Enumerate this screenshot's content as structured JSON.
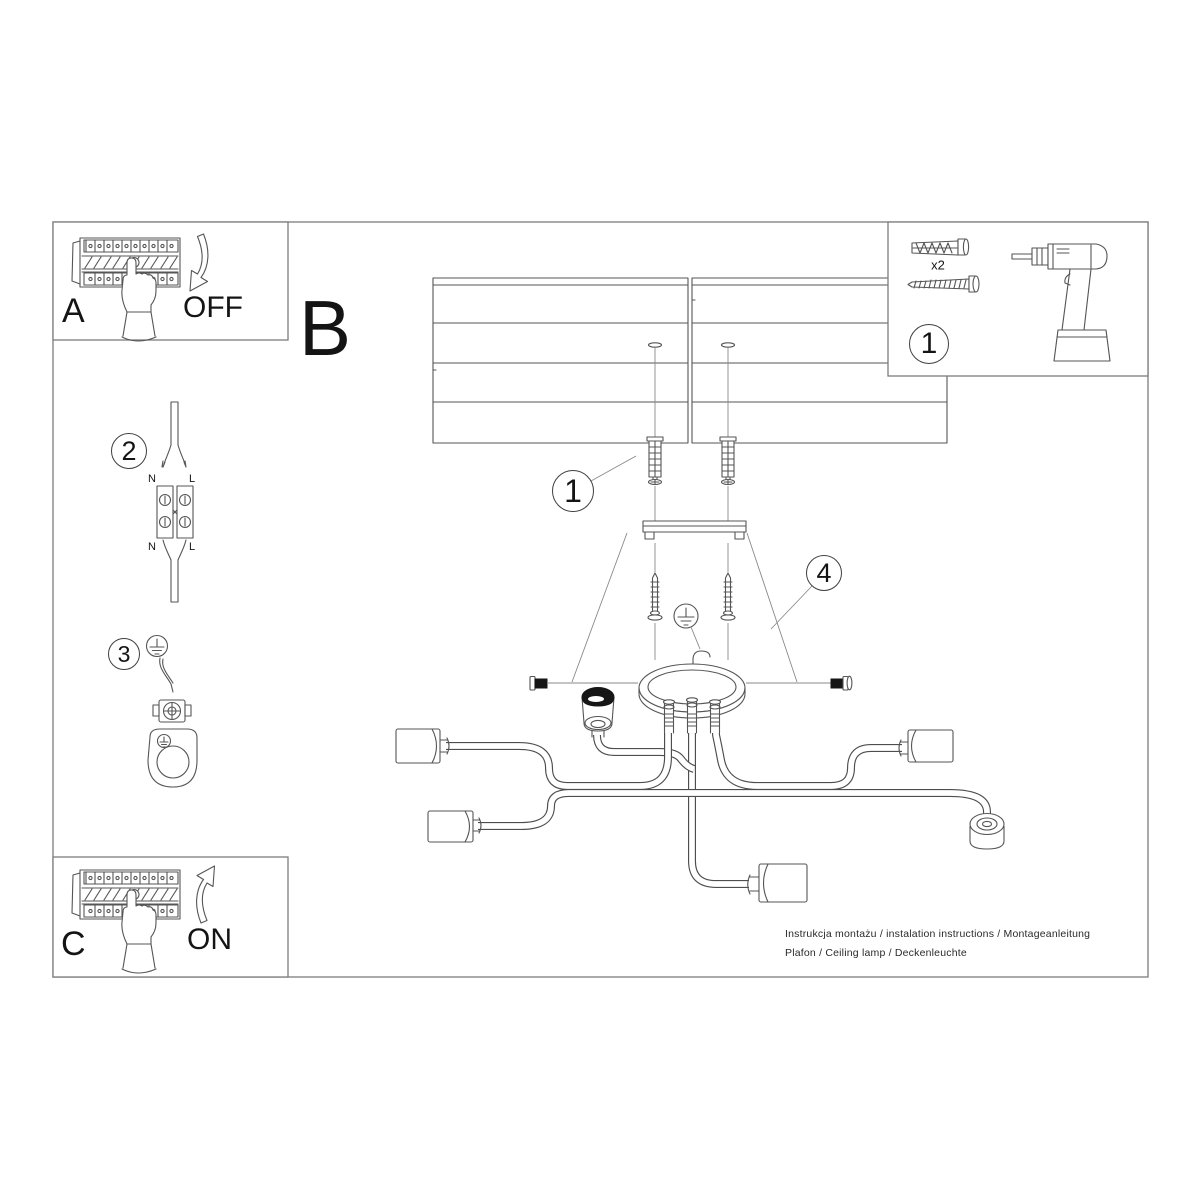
{
  "colors": {
    "line": "#555555",
    "border": "#7d7d7d",
    "text": "#141414"
  },
  "sections": {
    "a": {
      "label": "A",
      "state": "OFF"
    },
    "b": {
      "label": "B"
    },
    "c": {
      "label": "C",
      "state": "ON"
    },
    "parts": {
      "number": "1",
      "plug_count": "x2"
    }
  },
  "callouts": {
    "anchors": "1",
    "wires": "2",
    "ground": "3",
    "canopy": "4"
  },
  "wiring": {
    "top_left": "N",
    "top_right": "L",
    "bottom_left": "N",
    "bottom_right": "L"
  },
  "footer": {
    "line1": "Instrukcja montażu / instalation instructions / Montageanleitung",
    "line2": "Plafon / Ceiling lamp / Deckenleuchte"
  }
}
